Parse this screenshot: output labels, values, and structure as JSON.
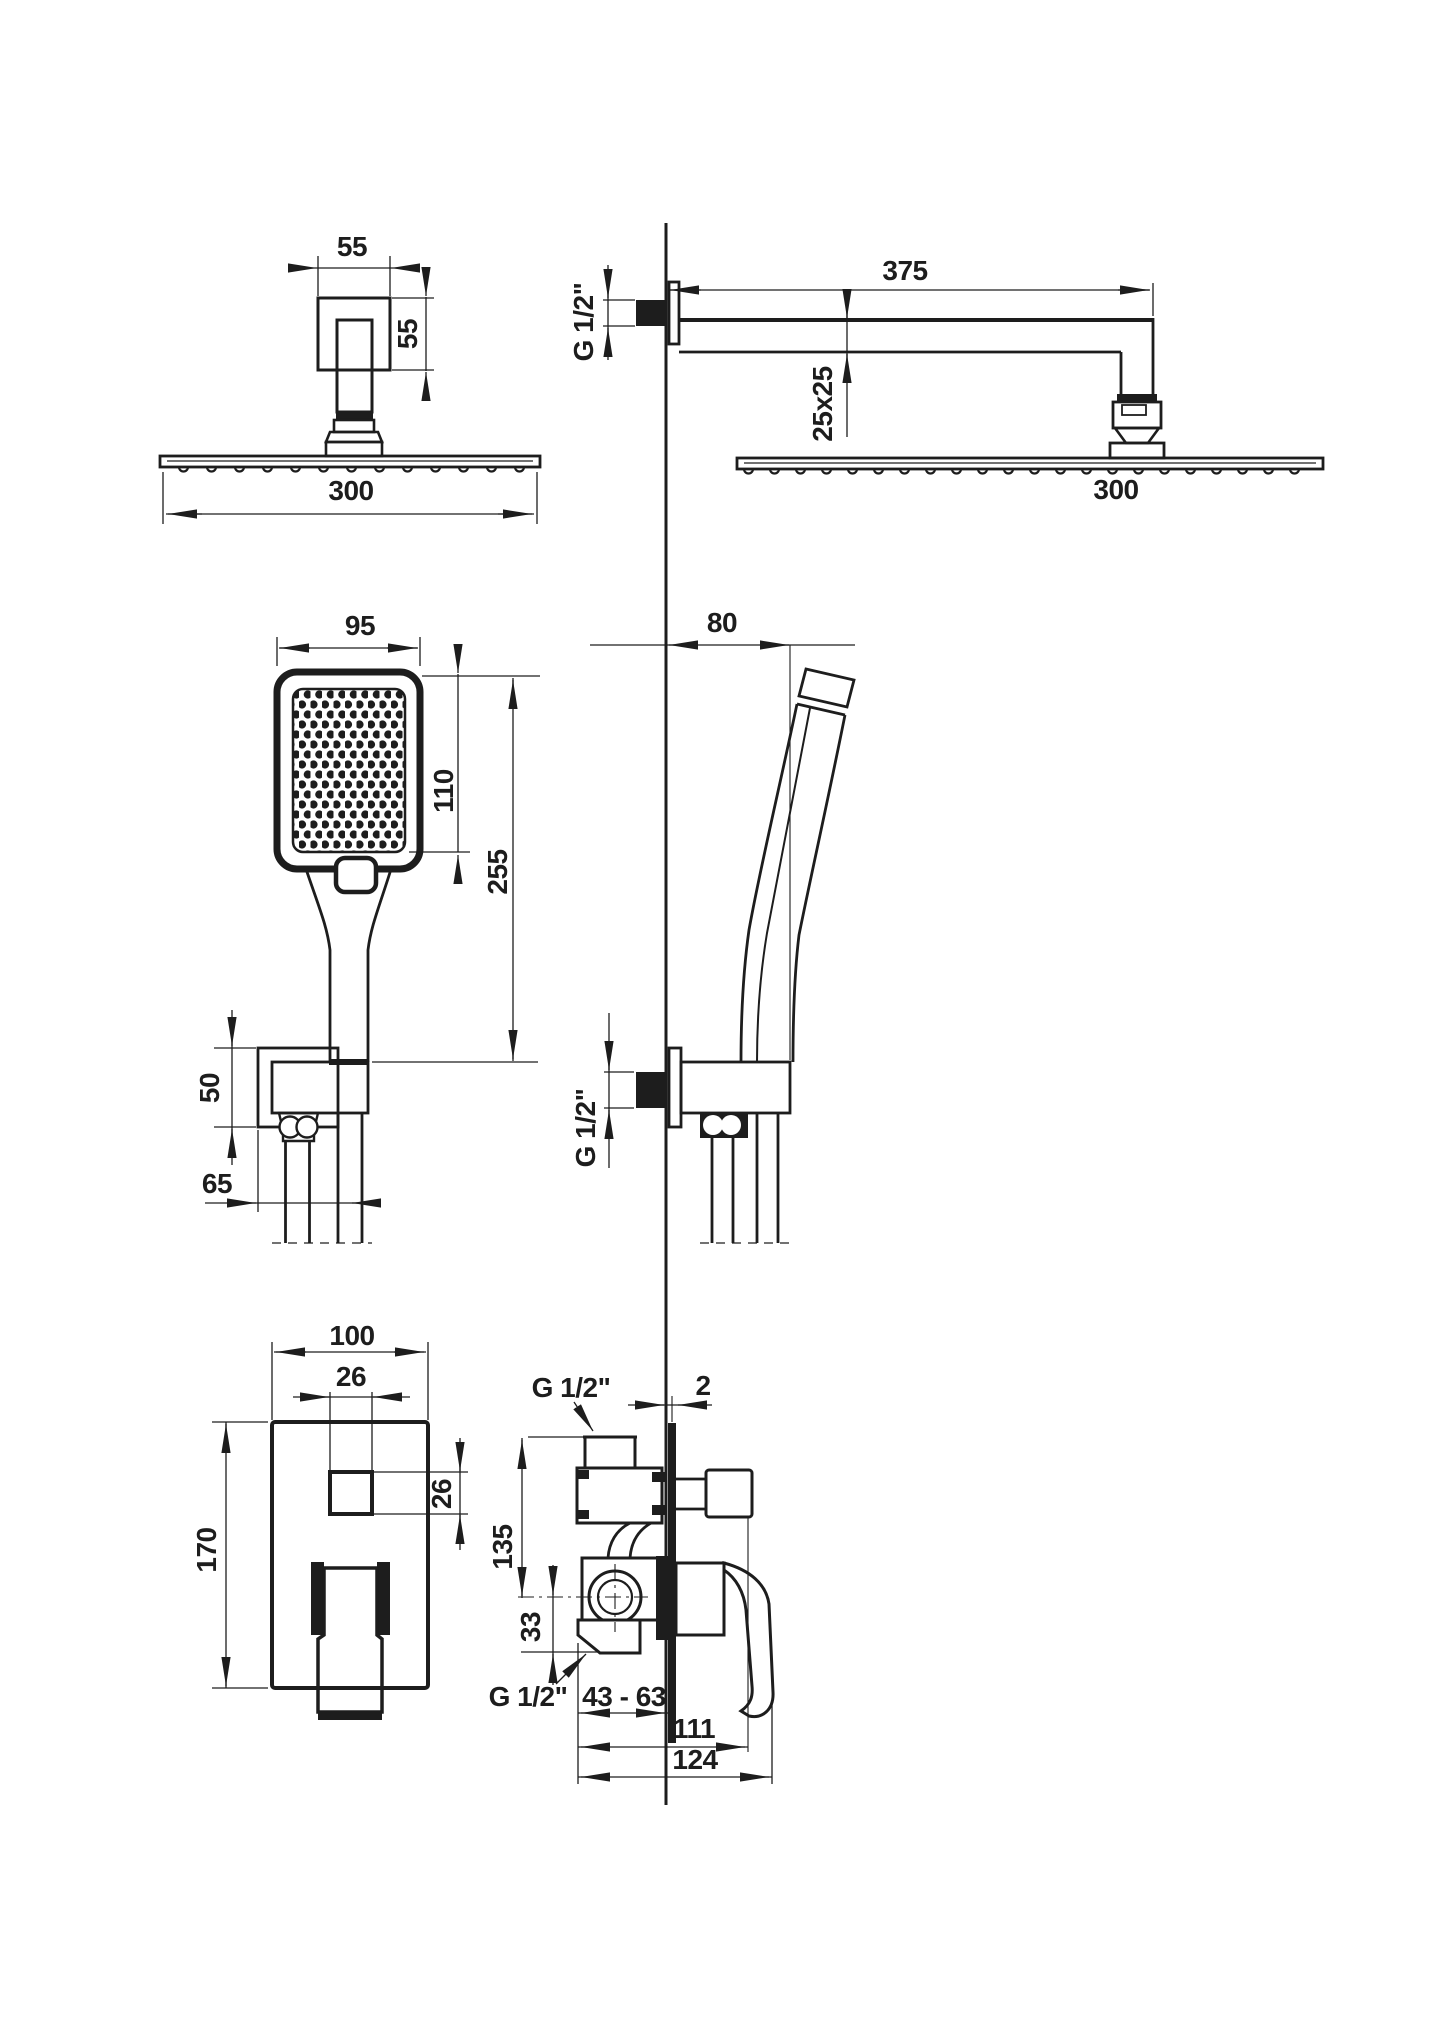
{
  "page": {
    "background": "#ffffff",
    "line_color": "#1d1d1d"
  },
  "views": {
    "shower_head_front": {
      "dims": {
        "escutcheon_width": "55",
        "escutcheon_height": "55",
        "head_width": "300"
      }
    },
    "shower_arm_side": {
      "dims": {
        "arm_reach": "375",
        "wall_thread": "G 1/2\"",
        "arm_section": "25x25",
        "head_width": "300"
      }
    },
    "hand_shower_front": {
      "dims": {
        "head_width": "95",
        "face_height": "110",
        "total_length": "255",
        "holder_height": "50",
        "hose_offset": "65"
      }
    },
    "hand_shower_side": {
      "dims": {
        "wall_offset": "80",
        "wall_thread": "G 1/2\""
      }
    },
    "mixer_front": {
      "dims": {
        "plate_width": "100",
        "button_width": "26",
        "button_height": "26",
        "plate_height": "170"
      }
    },
    "mixer_side": {
      "dims": {
        "top_thread": "G 1/2\"",
        "plate_thickness": "2",
        "body_height": "135",
        "outlet_offset": "33",
        "bottom_thread": "G 1/2\"",
        "mount_depth": "43 - 63",
        "reach_inner": "111",
        "reach_outer": "124"
      }
    }
  }
}
